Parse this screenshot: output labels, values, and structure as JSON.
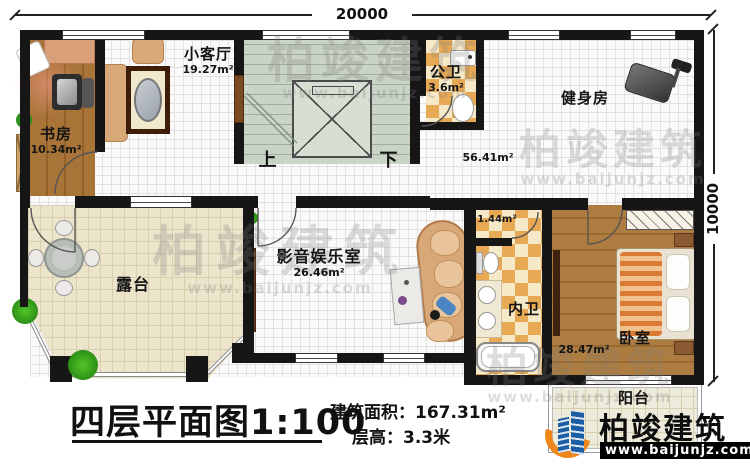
{
  "dimensions": {
    "width_top": "20000",
    "height_right": "10000"
  },
  "rooms": {
    "study": {
      "name": "书房",
      "area": "10.34m²"
    },
    "small_living": {
      "name": "小客厅",
      "area": "19.27m²"
    },
    "public_bath": {
      "name": "公卫",
      "area": "3.6m²"
    },
    "gym": {
      "name": "健身房",
      "area": "56.41m²"
    },
    "terrace": {
      "name": "露台"
    },
    "media_room": {
      "name": "影音娱乐室",
      "area": "26.46m²"
    },
    "inner_bath": {
      "name": "内卫",
      "area": "1.44m²"
    },
    "bedroom": {
      "name": "卧室",
      "area": "28.47m²"
    },
    "balcony": {
      "name": "阳台"
    },
    "stairs": {
      "up_label": "上",
      "down_label": "下"
    }
  },
  "title_block": {
    "plan_title": "四层平面图1:100",
    "area_label": "建筑面积：",
    "area_value": "167.31m²",
    "floor_height_label": "层高：",
    "floor_height_value": "3.3米"
  },
  "branding": {
    "company": "柏竣建筑",
    "website": "www.baijunjz.com"
  },
  "watermark": {
    "company": "柏竣建筑",
    "website": "www.baijunjz.com"
  },
  "colors": {
    "wall": "#161616",
    "checker": "#e7a953",
    "wood": "#a87438",
    "stair": "#c9d3c6",
    "terrace_floor": "#ece5cc",
    "logo_blue": "#1b5ea6",
    "logo_orange": "#f08519"
  }
}
